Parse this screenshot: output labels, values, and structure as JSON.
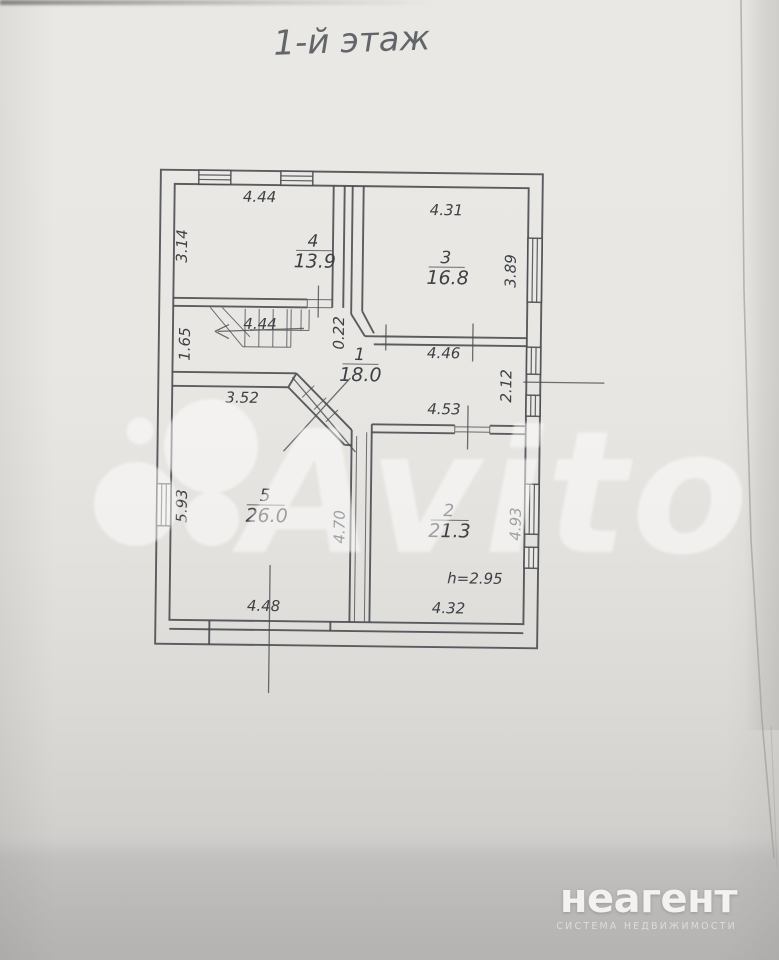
{
  "title": "1-й этаж",
  "plan": {
    "rooms": [
      {
        "number": "4",
        "area": "13.9"
      },
      {
        "number": "3",
        "area": "16.8"
      },
      {
        "number": "1",
        "area": "18.0"
      },
      {
        "number": "5",
        "area": "26.0"
      },
      {
        "number": "2",
        "area": "21.3"
      }
    ],
    "dims": {
      "top_left": "4.44",
      "room4_side": "3.14",
      "room3_top": "4.31",
      "room3_side": "3.89",
      "stair_side": "1.65",
      "stair_arrow": "4.44",
      "wall_gap": "0.22",
      "hall": "4.46",
      "right_gap": "2.12",
      "room5_top": "3.52",
      "room2_top": "4.53",
      "room5_side": "5.93",
      "divider": "4.70",
      "room2_side": "4.93",
      "room5_bottom": "4.48",
      "room2_bottom": "4.32",
      "ceiling_height": "h=2.95"
    }
  },
  "watermark": {
    "text": "Avito"
  },
  "brand": {
    "name": "неагент",
    "tagline": "СИСТЕМА НЕДВИЖИМОСТИ"
  }
}
